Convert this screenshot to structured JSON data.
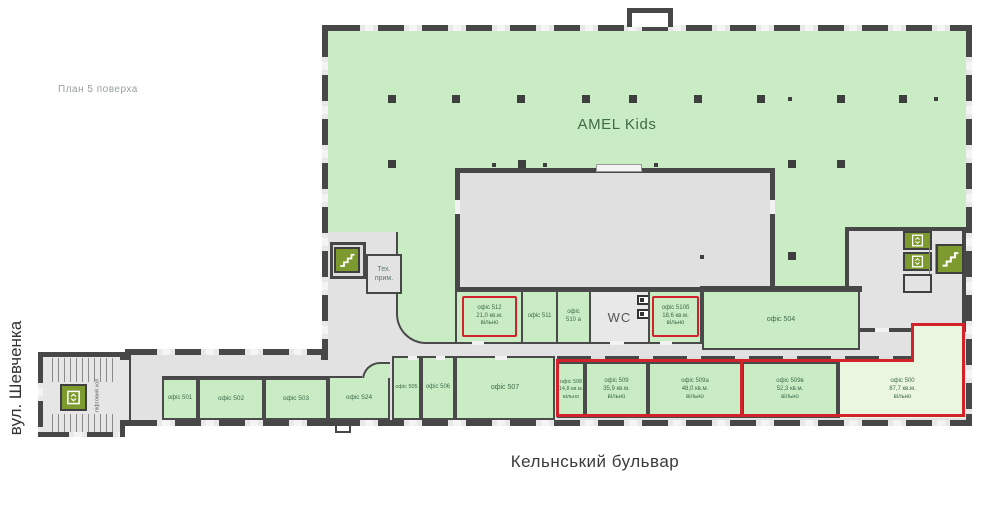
{
  "plan_title": "План 5 поверха",
  "street_left": "вул. Шевченка",
  "street_bottom": "Кельнський бульвар",
  "amel_label": "AMEL Kids",
  "wc_label": "WC",
  "tech_room": {
    "line1": "Тех.",
    "line2": "прим."
  },
  "lift_hall_label": "ліфтовий хол",
  "rooms_mid": [
    {
      "name": "офіс 512",
      "area": "21,0 кв.м.",
      "status": "вільно",
      "highlighted": true
    },
    {
      "name": "офіс 511"
    },
    {
      "name": "офіс",
      "name2": "510 а"
    },
    {
      "name": "офіс 510б",
      "area": "18,6 кв.м.",
      "status": "вільно",
      "highlighted": true
    },
    {
      "name": "офіс 504"
    }
  ],
  "rooms_bottom_left": [
    {
      "name": "офіс 501"
    },
    {
      "name": "офіс 502"
    },
    {
      "name": "офіс 503"
    },
    {
      "name": "офіс 524"
    },
    {
      "name": "офіс 505"
    },
    {
      "name": "офіс 506"
    },
    {
      "name": "офіс 507"
    }
  ],
  "rooms_bottom_right": [
    {
      "name": "офіс 508",
      "area": "14,8 кв.м.",
      "status": "вільно"
    },
    {
      "name": "офіс 509",
      "area": "35,9 кв.м.",
      "status": "вільно"
    },
    {
      "name": "офіс 509а",
      "area": "48,0 кв.м.",
      "status": "вільно"
    },
    {
      "name": "офіс 509в",
      "area": "52,3 кв.м.",
      "status": "вільно"
    },
    {
      "name": "офіс 500",
      "area": "87,7 кв.м.",
      "status": "вільно"
    }
  ],
  "colors": {
    "highlight_red": "#d2232a",
    "room_green": "#c9ecc4",
    "room_pale": "#eaf6df",
    "wall": "#474747",
    "stair_olive": "#7c9a2d",
    "label_green": "#3e6b4c"
  }
}
